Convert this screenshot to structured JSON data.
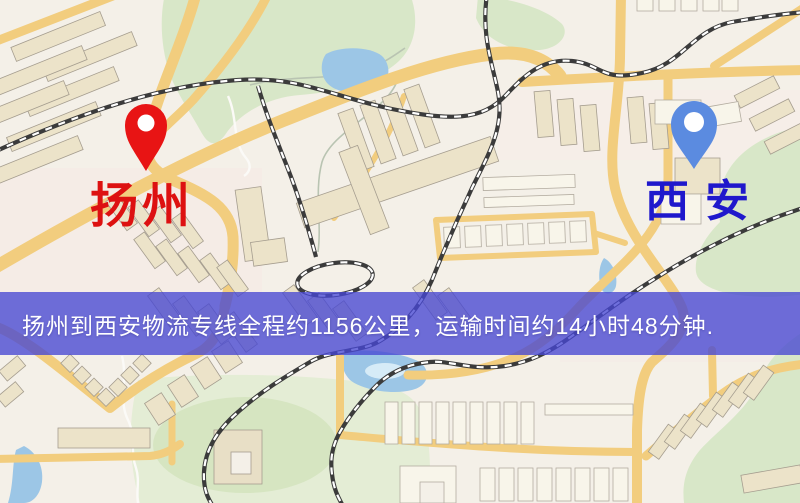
{
  "markers": {
    "origin": {
      "label": "扬州",
      "pin_color": "#e81414",
      "label_color": "#dd1111"
    },
    "destination": {
      "label": "西安",
      "pin_color": "#5b8be0",
      "label_color": "#1f18cc"
    }
  },
  "banner": {
    "text": "扬州到西安物流专线全程约1156公里，运输时间约14小时48分钟.",
    "background": "#4747d2",
    "text_color": "#ffffff"
  },
  "map": {
    "style": "street-map",
    "background_color": "#f4f0e8",
    "road_color": "#f2cd7e",
    "water_color": "#9cc6e6",
    "green_color": "#d8e7c8",
    "railway_color": "#3b3b3b",
    "distance_km": "1156",
    "duration": "14小时48分钟"
  }
}
